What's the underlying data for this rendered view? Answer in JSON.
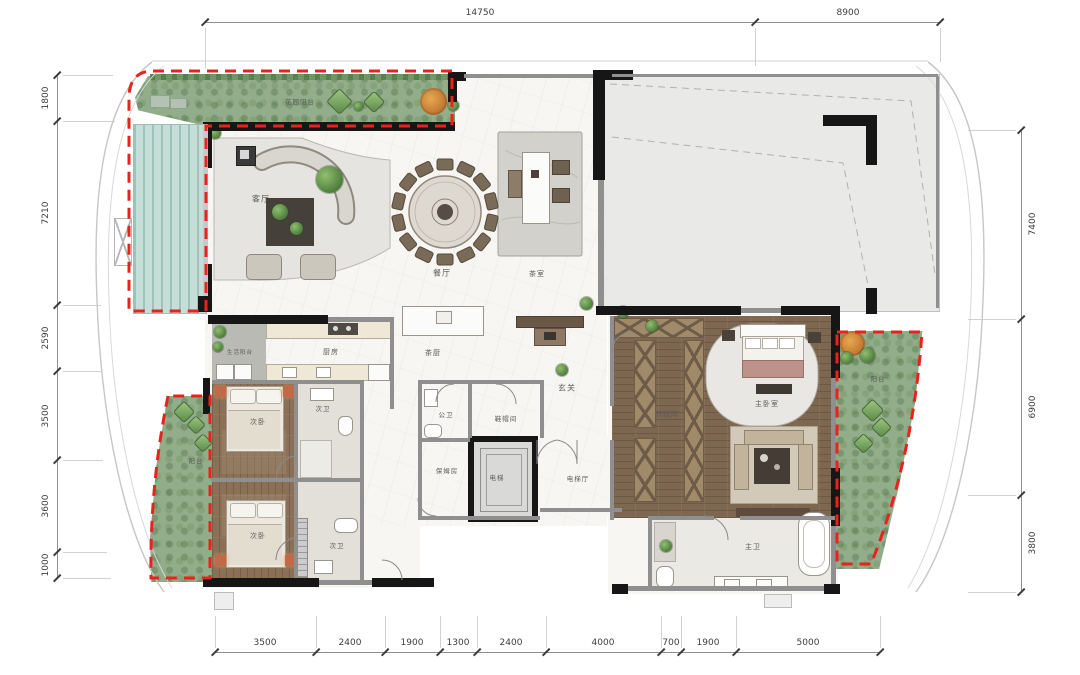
{
  "dimensions": {
    "top": [
      "14750",
      "8900"
    ],
    "bottom": [
      "3500",
      "2400",
      "1900",
      "1300",
      "2400",
      "4000",
      "700",
      "1900",
      "5000"
    ],
    "left": [
      "1800",
      "7210",
      "2590",
      "3500",
      "3600",
      "1000"
    ],
    "right": [
      "7400",
      "6900",
      "3800"
    ]
  },
  "rooms": {
    "garden_balcony": "花园阳台",
    "living_room": "客厅",
    "dining_room": "餐厅",
    "tea_room": "茶室",
    "tea_kitchen": "茶厨",
    "foyer": "玄关",
    "guest_bath": "公卫",
    "cloakroom": "鞋帽间",
    "nanny_room": "保姆房",
    "elevator": "电梯",
    "elevator_hall": "电梯厅",
    "service_balcony": "生活阳台",
    "kitchen": "厨房",
    "bedroom_a": "次卧",
    "bath_a": "次卫",
    "bedroom_b": "次卧",
    "bath_b": "次卫",
    "balcony_left": "阳台",
    "balcony_right": "阳台",
    "walk_in_closet": "衣帽间",
    "master_bedroom": "主卧室",
    "master_bath": "主卫"
  },
  "colors": {
    "balcony_boundary_red": "#e8221c",
    "landscape_green": "#92ad8a",
    "pool_teal": "#c6ded8",
    "wood_floor": "#8a7056",
    "wall_black": "#161616",
    "void_gray": "#e9e9e7"
  }
}
